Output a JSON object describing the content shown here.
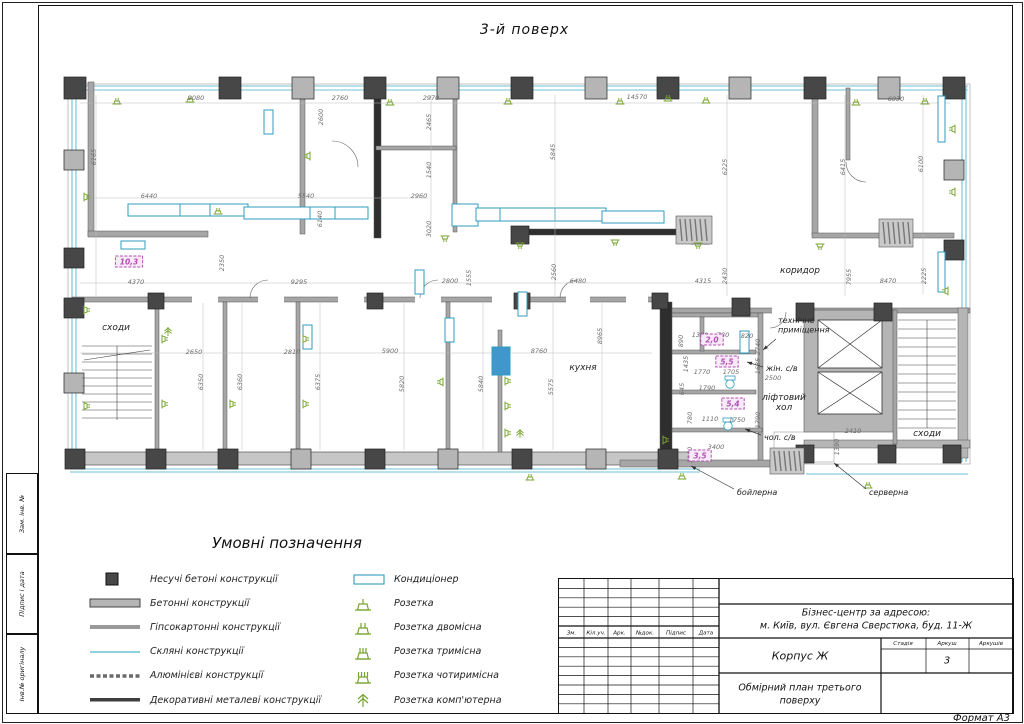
{
  "sheet": {
    "title": "3-й поверх"
  },
  "side_strip": {
    "labels": [
      "Зам. інв. №",
      "Підпис і дата",
      "Інв.№ оригіналу"
    ]
  },
  "legend": {
    "title": "Умовні позначення",
    "left": [
      {
        "icon": "sq",
        "label": "Несучі бетоні конструкції"
      },
      {
        "icon": "bar",
        "label": "Бетонні конструкції"
      },
      {
        "icon": "line-gray",
        "label": "Гіпсокартонні конструкції"
      },
      {
        "icon": "line-cyan",
        "label": "Скляні конструкції"
      },
      {
        "icon": "line-dash",
        "label": "Алюмінієві конструкції"
      },
      {
        "icon": "line-dark",
        "label": "Декоративні металеві конструкції"
      }
    ],
    "right": [
      {
        "icon": "ac",
        "label": "Кондиціонер"
      },
      {
        "icon": "sock1",
        "label": "Розетка"
      },
      {
        "icon": "sock2",
        "label": "Розетка двомісна"
      },
      {
        "icon": "sock3",
        "label": "Розетка тримісна"
      },
      {
        "icon": "sock4",
        "label": "Розетка чотиримісна"
      },
      {
        "icon": "sockpc",
        "label": "Розетка комп'ютерна"
      }
    ]
  },
  "titleblock": {
    "header_cols": [
      "Зм.",
      "Кіл.уч.",
      "Арк.",
      "№док.",
      "Підпис",
      "Дата"
    ],
    "project_line1": "Бізнес-центр за адресою:",
    "project_line2": "м. Київ, вул. Євгена Сверстюка, буд. 11-Ж",
    "block_name": "Корпус Ж",
    "stage_label": "Стадія",
    "sheet_label": "Аркуш",
    "sheets_label": "Аркушів",
    "sheet_number": "3",
    "doc_line1": "Обмірний план третього",
    "doc_line2": "поверху",
    "format_label": "Формат А3"
  },
  "colors": {
    "glass": "#6fc3d6",
    "duct": "#2e9dbf",
    "socket": "#76a32c",
    "badge": "#b44fb4",
    "badge_bg": "#f8eaf8",
    "column_dark": "#474747",
    "column_gray": "#b5b5b5",
    "wall": "#a6a6a6",
    "wall_light": "#c6c6c6",
    "dim": "#6b6b6b",
    "line": "#1a1a1a",
    "fill_blue": "#3f97cc",
    "dark_wall": "#2e2e2e"
  },
  "plan": {
    "rooms": [
      {
        "t": "сходи",
        "x": 116,
        "y": 330
      },
      {
        "t": "кухня",
        "x": 583,
        "y": 370
      },
      {
        "t": "коридор",
        "x": 800,
        "y": 273
      },
      {
        "t": "сходи",
        "x": 927,
        "y": 436
      },
      {
        "t": "ліфтовий\nхол",
        "x": 784,
        "y": 400
      }
    ],
    "annotations": [
      {
        "t": "технічне\nприміщення",
        "x": 778,
        "y": 323,
        "l": [
          776,
          339,
          763,
          350
        ]
      },
      {
        "t": "жін. с/в",
        "x": 766,
        "y": 371,
        "l": [
          763,
          367,
          747,
          362
        ]
      },
      {
        "t": "чол. с/в",
        "x": 764,
        "y": 440,
        "l": [
          761,
          435,
          745,
          429
        ]
      },
      {
        "t": "бойлерна",
        "x": 737,
        "y": 495,
        "l": [
          734,
          489,
          691,
          466
        ]
      },
      {
        "t": "серверна",
        "x": 869,
        "y": 495,
        "l": [
          866,
          489,
          834,
          463
        ]
      }
    ],
    "badges": [
      {
        "t": "10,3",
        "x": 129,
        "y": 262
      },
      {
        "t": "2,0",
        "x": 712,
        "y": 340
      },
      {
        "t": "5,5",
        "x": 727,
        "y": 362
      },
      {
        "t": "5,4",
        "x": 733,
        "y": 404
      },
      {
        "t": "3,5",
        "x": 700,
        "y": 456
      }
    ],
    "dimensions": [
      [
        "9080",
        196,
        100,
        0
      ],
      [
        "2760",
        340,
        100,
        0
      ],
      [
        "2970",
        431,
        100,
        0
      ],
      [
        "14570",
        637,
        99,
        0
      ],
      [
        "6030",
        896,
        101,
        0
      ],
      [
        "6165",
        96,
        157,
        1
      ],
      [
        "2600",
        323,
        117,
        1
      ],
      [
        "2465",
        431,
        122,
        1
      ],
      [
        "1540",
        431,
        170,
        1
      ],
      [
        "3020",
        431,
        229,
        1
      ],
      [
        "5845",
        555,
        152,
        1
      ],
      [
        "6225",
        727,
        167,
        1
      ],
      [
        "6415",
        845,
        167,
        1
      ],
      [
        "6100",
        923,
        164,
        1
      ],
      [
        "6440",
        149,
        198,
        0
      ],
      [
        "5540",
        306,
        198,
        0
      ],
      [
        "2960",
        419,
        198,
        0
      ],
      [
        "6140",
        322,
        219,
        1
      ],
      [
        "2350",
        224,
        263,
        1
      ],
      [
        "4370",
        136,
        284,
        0
      ],
      [
        "9295",
        299,
        284,
        0
      ],
      [
        "2800",
        450,
        283,
        0
      ],
      [
        "1555",
        471,
        278,
        1
      ],
      [
        "2560",
        556,
        272,
        1
      ],
      [
        "6480",
        578,
        283,
        0
      ],
      [
        "4315",
        703,
        283,
        0
      ],
      [
        "2430",
        727,
        276,
        1
      ],
      [
        "7955",
        851,
        277,
        1
      ],
      [
        "8470",
        888,
        283,
        0
      ],
      [
        "2225",
        926,
        276,
        1
      ],
      [
        "2650",
        194,
        354,
        0
      ],
      [
        "2810",
        292,
        354,
        0
      ],
      [
        "5900",
        390,
        353,
        0
      ],
      [
        "8760",
        539,
        353,
        0
      ],
      [
        "6350",
        203,
        382,
        1
      ],
      [
        "6360",
        242,
        382,
        1
      ],
      [
        "6375",
        320,
        382,
        1
      ],
      [
        "5820",
        404,
        384,
        1
      ],
      [
        "5840",
        483,
        384,
        1
      ],
      [
        "5575",
        553,
        387,
        1
      ],
      [
        "8965",
        602,
        336,
        1
      ],
      [
        "890",
        683,
        341,
        1
      ],
      [
        "1360",
        700,
        337,
        0
      ],
      [
        "780",
        723,
        337,
        0
      ],
      [
        "820",
        747,
        338,
        0
      ],
      [
        "2740",
        760,
        347,
        1
      ],
      [
        "1435",
        688,
        364,
        1
      ],
      [
        "1770",
        702,
        374,
        0
      ],
      [
        "1705",
        731,
        374,
        0
      ],
      [
        "1635",
        760,
        366,
        1
      ],
      [
        "645",
        684,
        389,
        1
      ],
      [
        "1790",
        707,
        390,
        0
      ],
      [
        "2500",
        773,
        380,
        0
      ],
      [
        "780",
        692,
        418,
        1
      ],
      [
        "1110",
        710,
        421,
        0
      ],
      [
        "1750",
        737,
        422,
        0
      ],
      [
        "1790",
        760,
        420,
        1
      ],
      [
        "1160",
        692,
        455,
        1
      ],
      [
        "3400",
        716,
        449,
        0
      ],
      [
        "2410",
        853,
        433,
        0
      ],
      [
        "1390",
        839,
        447,
        1
      ]
    ],
    "sockets": [
      [
        117,
        104,
        0
      ],
      [
        190,
        102,
        0
      ],
      [
        390,
        105,
        0
      ],
      [
        508,
        104,
        0
      ],
      [
        620,
        104,
        0
      ],
      [
        668,
        101,
        0
      ],
      [
        706,
        103,
        0
      ],
      [
        856,
        105,
        0
      ],
      [
        925,
        104,
        0
      ],
      [
        84,
        197,
        90
      ],
      [
        84,
        310,
        90
      ],
      [
        84,
        406,
        90
      ],
      [
        955,
        129,
        270
      ],
      [
        955,
        192,
        270
      ],
      [
        948,
        291,
        270
      ],
      [
        520,
        243,
        180
      ],
      [
        615,
        240,
        180
      ],
      [
        698,
        243,
        180
      ],
      [
        820,
        244,
        180
      ],
      [
        162,
        339,
        90
      ],
      [
        162,
        404,
        90
      ],
      [
        230,
        404,
        90
      ],
      [
        303,
        339,
        90
      ],
      [
        303,
        404,
        90
      ],
      [
        443,
        382,
        270
      ],
      [
        505,
        381,
        90
      ],
      [
        505,
        406,
        90
      ],
      [
        505,
        433,
        90
      ],
      [
        310,
        156,
        270
      ],
      [
        445,
        236,
        180
      ],
      [
        218,
        214,
        0
      ],
      [
        663,
        440,
        90
      ],
      [
        530,
        480,
        0
      ],
      [
        682,
        479,
        0
      ],
      [
        868,
        488,
        0
      ]
    ],
    "pc_sockets": [
      [
        520,
        438
      ],
      [
        168,
        336
      ]
    ],
    "ac_units": [
      [
        264,
        110,
        9,
        24,
        0
      ],
      [
        121,
        241,
        24,
        8,
        0
      ],
      [
        415,
        270,
        9,
        24,
        0
      ],
      [
        303,
        325,
        9,
        24,
        0
      ],
      [
        445,
        318,
        9,
        24,
        0
      ],
      [
        518,
        292,
        9,
        24,
        0
      ],
      [
        740,
        331,
        9,
        22,
        0
      ],
      [
        938,
        96,
        7,
        46,
        0
      ],
      [
        938,
        252,
        7,
        40,
        0
      ],
      [
        492,
        347,
        18,
        28,
        1
      ]
    ],
    "grilles": [
      [
        676,
        216,
        36,
        28
      ],
      [
        879,
        219,
        34,
        28
      ],
      [
        770,
        448,
        34,
        26
      ]
    ]
  }
}
